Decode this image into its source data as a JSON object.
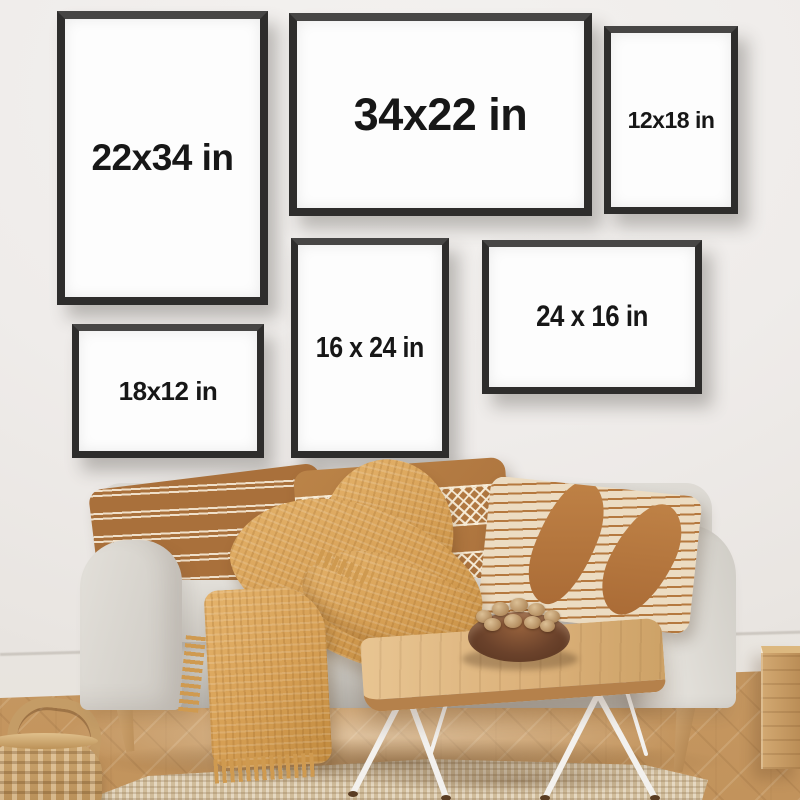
{
  "frames": [
    {
      "id": "frame-22x34",
      "label": "22x34 in",
      "orientation": "portrait"
    },
    {
      "id": "frame-34x22",
      "label": "34x22 in",
      "orientation": "landscape"
    },
    {
      "id": "frame-12x18",
      "label": "12x18 in",
      "orientation": "portrait"
    },
    {
      "id": "frame-18x12",
      "label": "18x12 in",
      "orientation": "landscape"
    },
    {
      "id": "frame-16x24",
      "label": "16 x 24 in",
      "orientation": "portrait"
    },
    {
      "id": "frame-24x16",
      "label": "24 x 16 in",
      "orientation": "landscape"
    }
  ],
  "palette": {
    "wall": "#efece9",
    "frame_border": "#2e2d2c",
    "label_text": "#171717",
    "sofa_fabric": "#d5d2cb",
    "pillow_rust": "#a9703b",
    "pillow_caramel": "#b67f44",
    "pillow_cream": "#ecdcc2",
    "blanket_mustard": "#d69f54",
    "table_wood": "#dcb27b",
    "floor_wood": "#c89c67",
    "rug": "#d8c6a7",
    "bowl_walnut": "#6b422b",
    "basket": "#c49c66",
    "hairpin_leg": "#f3f1ee"
  }
}
